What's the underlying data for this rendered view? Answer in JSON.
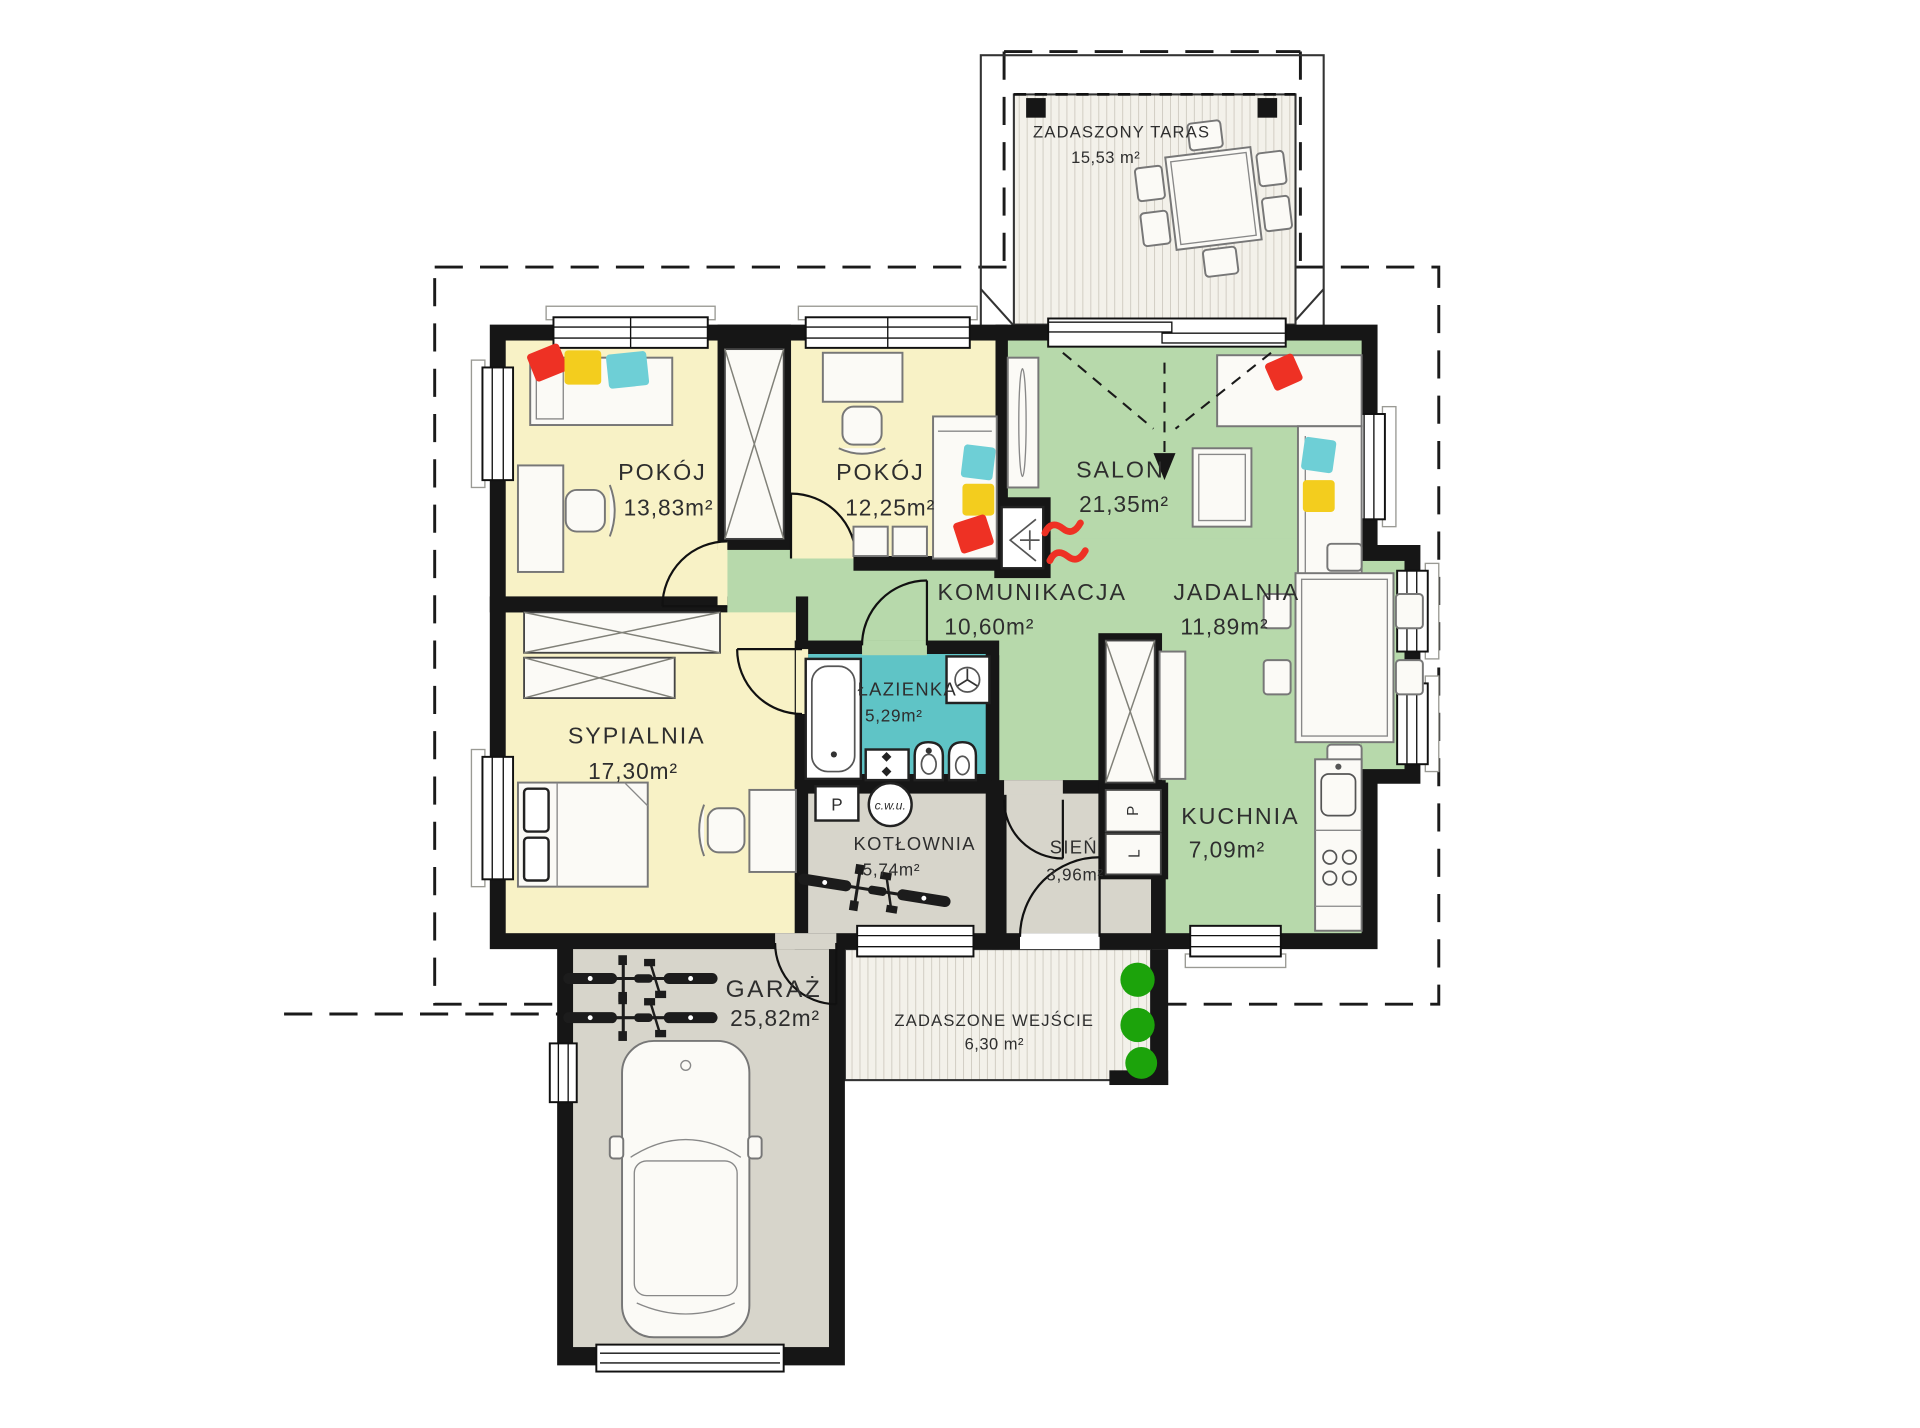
{
  "plan": {
    "type": "architectural-floor-plan",
    "language": "pl",
    "rooms": [
      {
        "id": "taras",
        "name": "ZADASZONY TARAS",
        "area": "15,53 m²"
      },
      {
        "id": "pokoj-1",
        "name": "POKÓJ",
        "area": "13,83m²"
      },
      {
        "id": "pokoj-2",
        "name": "POKÓJ",
        "area": "12,25m²"
      },
      {
        "id": "salon",
        "name": "SALON",
        "area": "21,35m²"
      },
      {
        "id": "komunikacja",
        "name": "KOMUNIKACJA",
        "area": "10,60m²"
      },
      {
        "id": "jadalnia",
        "name": "JADALNIA",
        "area": "11,89m²"
      },
      {
        "id": "lazienka",
        "name": "ŁAZIENKA",
        "area": "5,29m²"
      },
      {
        "id": "sypialnia",
        "name": "SYPIALNIA",
        "area": "17,30m²"
      },
      {
        "id": "kotlownia",
        "name": "KOTŁOWNIA",
        "area": "5,74m²"
      },
      {
        "id": "sien",
        "name": "SIEŃ",
        "area": "3,96m²"
      },
      {
        "id": "kuchnia",
        "name": "KUCHNIA",
        "area": "7,09m²"
      },
      {
        "id": "garaz",
        "name": "GARAŻ",
        "area": "25,82m²"
      },
      {
        "id": "wejscie",
        "name": "ZADASZONE WEJŚCIE",
        "area": "6,30 m²"
      }
    ],
    "equipment": {
      "boiler": "P",
      "hot_water": "c.w.u.",
      "cabinet_top": "P",
      "cabinet_bottom": "L"
    },
    "colors": {
      "wall": "#161616",
      "room_yellow": "#f8f2c6",
      "room_green": "#b7d9ab",
      "room_teal": "#5fc4c6",
      "room_gray": "#d7d5cb",
      "deck": "#f3f1ea",
      "deck_stripe": "#c9c5ba",
      "accent_red": "#ee3124",
      "pillow_yellow": "#f3cd1e",
      "pillow_teal": "#6ecfd6",
      "shrub_green": "#1ca30b",
      "text": "#2e2e2e"
    }
  }
}
